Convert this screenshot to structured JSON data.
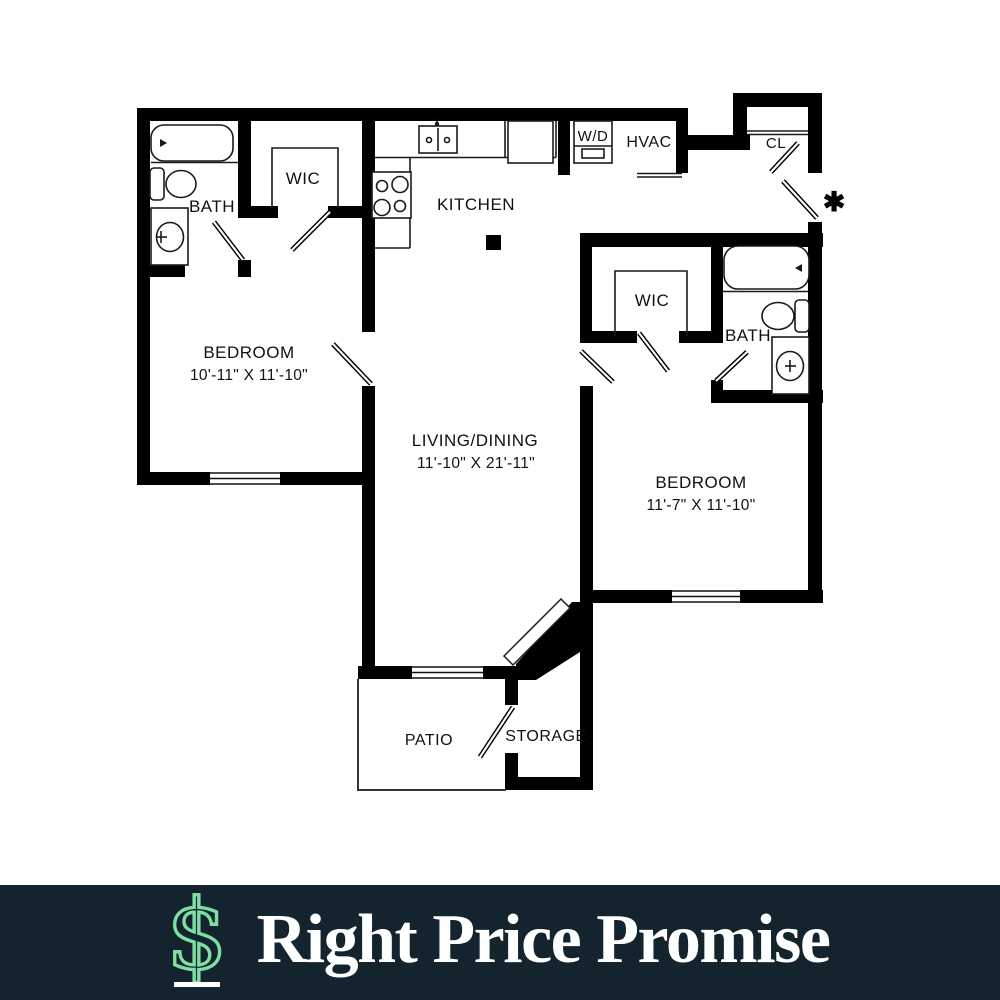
{
  "plan": {
    "labels": {
      "bath_left": "BATH",
      "wic_left": "WIC",
      "kitchen": "KITCHEN",
      "wd": "W/D",
      "hvac": "HVAC",
      "cl": "CL",
      "bedroom_left_name": "BEDROOM",
      "bedroom_left_dims": "10'-11\" X 11'-10\"",
      "living_name": "LIVING/DINING",
      "living_dims": "11'-10\" X 21'-11\"",
      "wic_right": "WIC",
      "bath_right": "BATH",
      "bedroom_right_name": "BEDROOM",
      "bedroom_right_dims": "11'-7\" X 11'-10\"",
      "patio": "PATIO",
      "storage": "STORAGE",
      "entry_marker": "✱"
    },
    "colors": {
      "wall": "#000000",
      "background": "#ffffff"
    }
  },
  "footer": {
    "title": "Right Price Promise",
    "icon": "dollar-sign",
    "dollar_glyph": "$",
    "colors": {
      "background": "#13242F",
      "text": "#FFFFFF",
      "accent": "#7EDFA4"
    }
  }
}
